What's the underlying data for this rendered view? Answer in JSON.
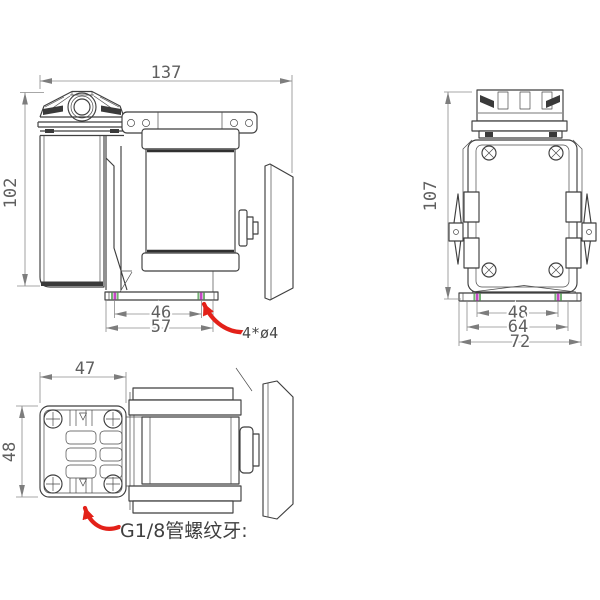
{
  "drawing": {
    "type": "engineering-dimension-drawing",
    "subject": "miniature diaphragm vacuum pump, three orthographic views",
    "background": "#ffffff",
    "colors": {
      "part_line": "#3f3f3f",
      "dimension_line": "#8b8b8b",
      "dimension_text": "#5f5f5f",
      "annotation_red": "#e32119",
      "hole_mark_magenta": "#c446c4",
      "hole_mark_green": "#74b274"
    },
    "views": {
      "side": {
        "dimensions": {
          "overall_length": "137",
          "overall_height": "102",
          "mount_hole_spacing": "46",
          "base_length": "57"
        },
        "callouts": {
          "mount_holes": "4*ø4"
        }
      },
      "front": {
        "dimensions": {
          "overall_height": "107",
          "mount_hole_spacing": "48",
          "base_mid_width": "64",
          "base_width": "72"
        }
      },
      "top": {
        "dimensions": {
          "head_width": "47",
          "head_depth": "48"
        },
        "callouts": {
          "port_thread": "G1/8管螺纹牙:"
        }
      }
    }
  }
}
